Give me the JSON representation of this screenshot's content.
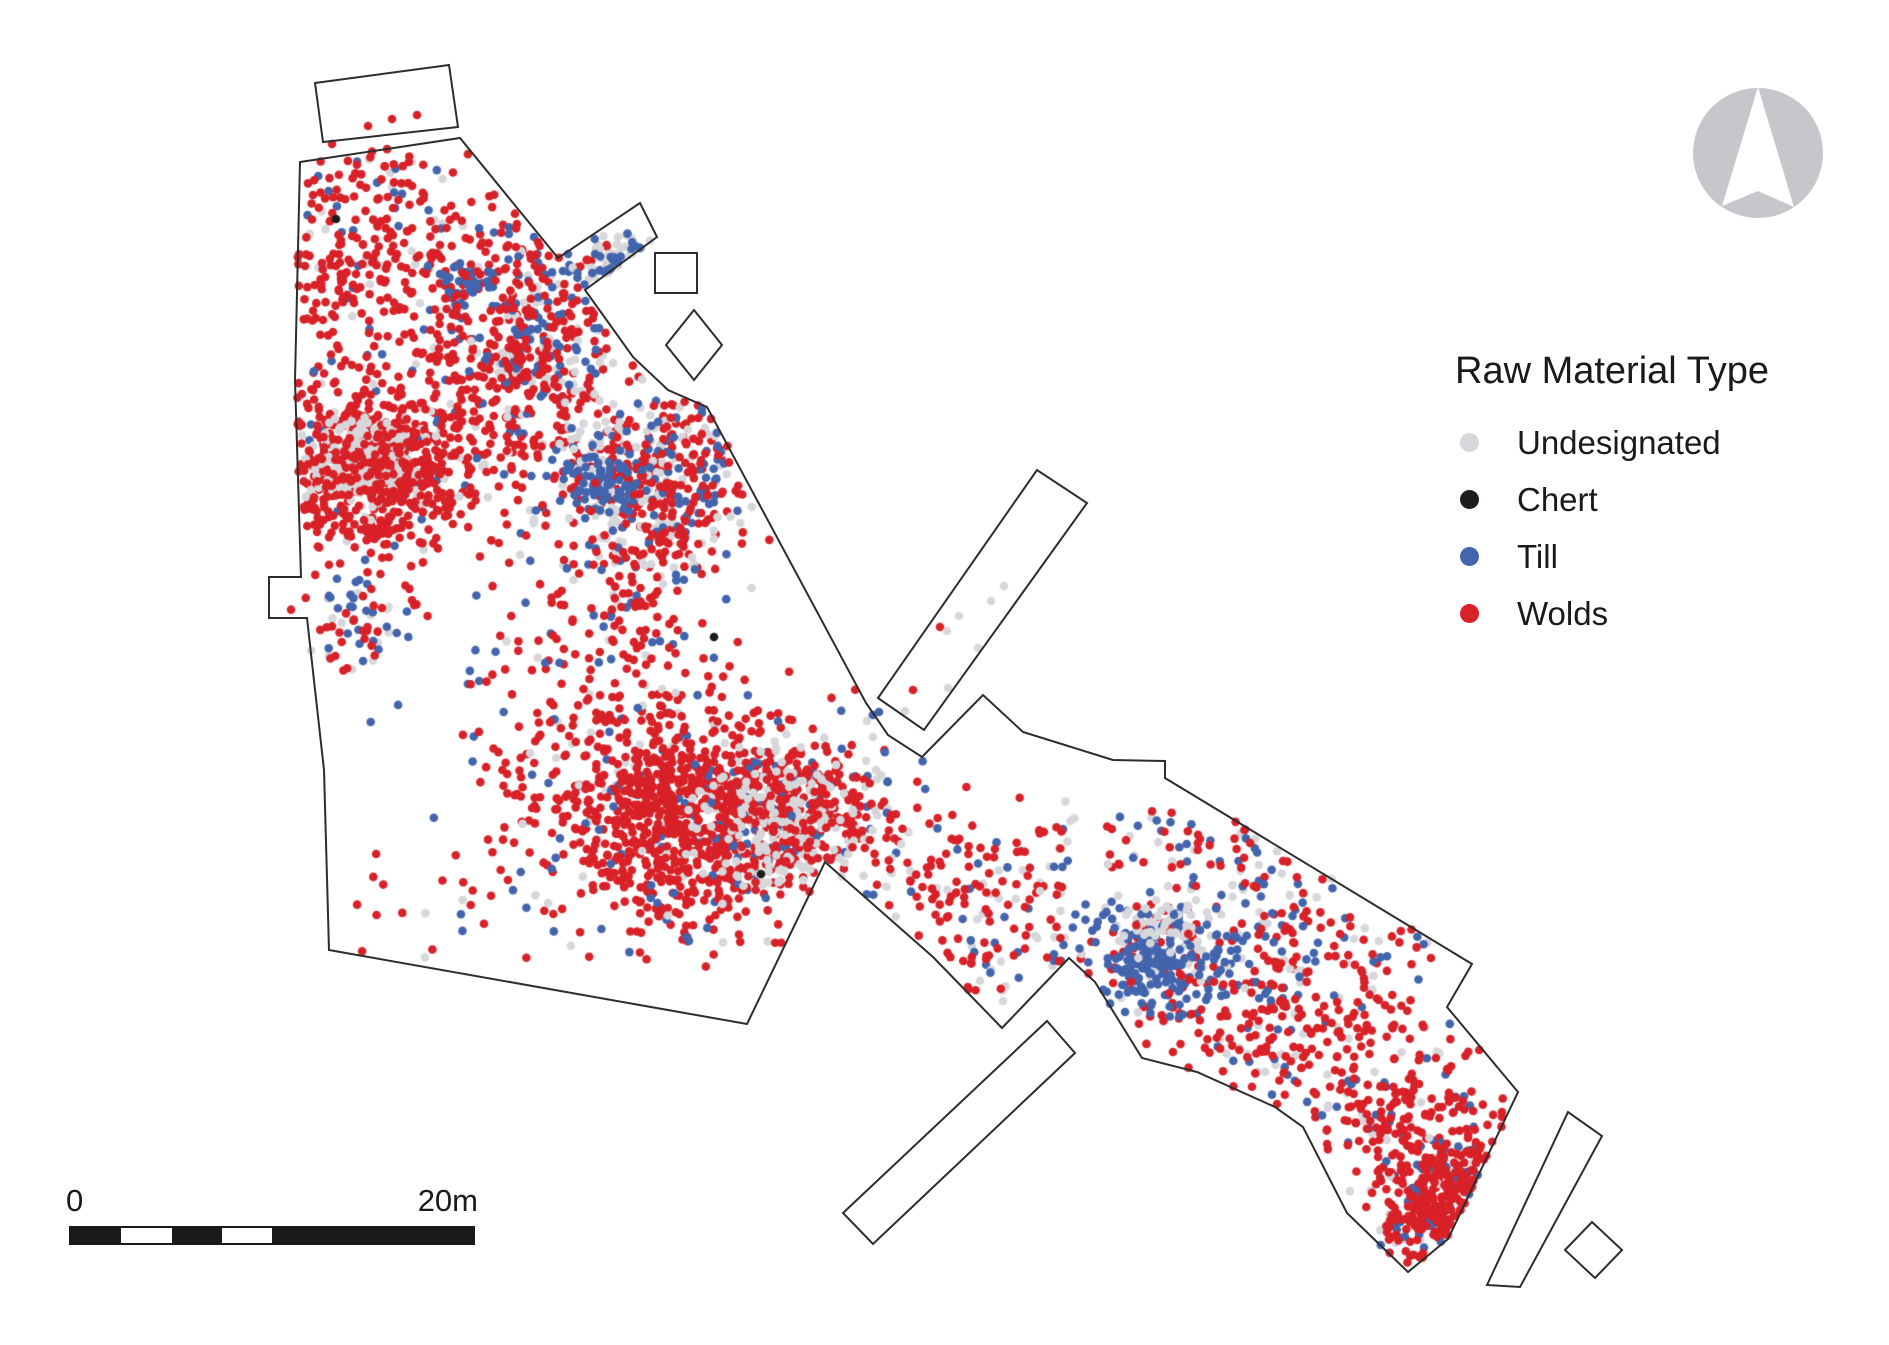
{
  "legend": {
    "title": "Raw Material Type",
    "items": [
      {
        "key": "undesignated",
        "label": "Undesignated",
        "color": "#d7d7db"
      },
      {
        "key": "chert",
        "label": "Chert",
        "color": "#1f1c1d"
      },
      {
        "key": "till",
        "label": "Till",
        "color": "#4365ad"
      },
      {
        "key": "wolds",
        "label": "Wolds",
        "color": "#d92128"
      }
    ]
  },
  "scale_bar": {
    "start_label": "0",
    "end_label": "20m",
    "total_m": 20,
    "width_px": 406,
    "color": "#1a1a1a",
    "segments": [
      {
        "m": 2.5,
        "fill": "dark"
      },
      {
        "m": 2.5,
        "fill": "light"
      },
      {
        "m": 2.5,
        "fill": "dark"
      },
      {
        "m": 2.5,
        "fill": "light"
      },
      {
        "m": 10,
        "fill": "dark"
      }
    ]
  },
  "north_arrow": {
    "cx": 1758,
    "cy": 153,
    "r": 65,
    "circle_color": "#c6c6cb",
    "arrow_color": "#ffffff",
    "arrow_points": [
      [
        1758,
        87
      ],
      [
        1794,
        207
      ],
      [
        1758,
        191
      ],
      [
        1722,
        206
      ]
    ]
  },
  "map": {
    "stroke_color": "#2d2d2d",
    "stroke_width": 2,
    "shapes": [
      {
        "name": "main-excavation-outline",
        "points": [
          [
            300,
            162
          ],
          [
            460,
            138
          ],
          [
            558,
            258
          ],
          [
            640,
            203
          ],
          [
            657,
            237
          ],
          [
            585,
            290
          ],
          [
            633,
            357
          ],
          [
            668,
            390
          ],
          [
            707,
            407
          ],
          [
            866,
            703
          ],
          [
            888,
            735
          ],
          [
            922,
            757
          ],
          [
            983,
            695
          ],
          [
            1023,
            732
          ],
          [
            1113,
            760
          ],
          [
            1165,
            761
          ],
          [
            1165,
            778
          ],
          [
            1472,
            964
          ],
          [
            1447,
            1007
          ],
          [
            1518,
            1092
          ],
          [
            1448,
            1239
          ],
          [
            1408,
            1272
          ],
          [
            1347,
            1213
          ],
          [
            1303,
            1127
          ],
          [
            1275,
            1107
          ],
          [
            1197,
            1072
          ],
          [
            1142,
            1058
          ],
          [
            1095,
            982
          ],
          [
            1069,
            958
          ],
          [
            1002,
            1028
          ],
          [
            933,
            957
          ],
          [
            825,
            862
          ],
          [
            747,
            1024
          ],
          [
            329,
            950
          ],
          [
            324,
            770
          ],
          [
            307,
            618
          ],
          [
            269,
            618
          ],
          [
            269,
            577
          ],
          [
            301,
            577
          ],
          [
            295,
            380
          ]
        ]
      },
      {
        "name": "north-detached-rectangle",
        "points": [
          [
            315,
            83
          ],
          [
            449,
            65
          ],
          [
            458,
            127
          ],
          [
            323,
            142
          ]
        ]
      },
      {
        "name": "small-square-ne",
        "points": [
          [
            655,
            253
          ],
          [
            697,
            253
          ],
          [
            697,
            293
          ],
          [
            655,
            293
          ]
        ]
      },
      {
        "name": "tilted-square-ne",
        "points": [
          [
            694,
            310
          ],
          [
            722,
            345
          ],
          [
            694,
            380
          ],
          [
            666,
            345
          ]
        ]
      },
      {
        "name": "long-rectangle-ne",
        "points": [
          [
            878,
            698
          ],
          [
            1037,
            470
          ],
          [
            1087,
            503
          ],
          [
            924,
            730
          ]
        ]
      },
      {
        "name": "long-rectangle-sw",
        "points": [
          [
            843,
            1213
          ],
          [
            1047,
            1021
          ],
          [
            1075,
            1053
          ],
          [
            873,
            1244
          ]
        ]
      },
      {
        "name": "long-rectangle-se",
        "points": [
          [
            1487,
            1285
          ],
          [
            1568,
            1112
          ],
          [
            1602,
            1136
          ],
          [
            1520,
            1287
          ]
        ]
      },
      {
        "name": "small-diamond-se",
        "points": [
          [
            1592,
            1222
          ],
          [
            1622,
            1250
          ],
          [
            1595,
            1278
          ],
          [
            1565,
            1250
          ]
        ]
      }
    ]
  },
  "chart_data": {
    "type": "scatter",
    "title": "Raw Material Type",
    "coordinate_space": "image pixels, 1889x1345, origin top-left",
    "point_radius": 4.3,
    "seed": 42,
    "categories": {
      "undesignated": {
        "label": "Undesignated",
        "color": "#d7d7db"
      },
      "chert": {
        "label": "Chert",
        "color": "#1f1c1d"
      },
      "till": {
        "label": "Till",
        "color": "#4365ad"
      },
      "wolds": {
        "label": "Wolds",
        "color": "#d92128"
      }
    },
    "clusters": [
      {
        "id": "nw-scatter",
        "cx": 385,
        "cy": 245,
        "sx": 62,
        "sy": 58,
        "parts": [
          [
            "undesignated",
            25
          ],
          [
            "till",
            30
          ],
          [
            "wolds",
            200
          ]
        ]
      },
      {
        "id": "nw-left-edge",
        "cx": 318,
        "cy": 300,
        "sx": 22,
        "sy": 55,
        "parts": [
          [
            "wolds",
            40
          ]
        ]
      },
      {
        "id": "nw-blue-patch",
        "cx": 462,
        "cy": 280,
        "sx": 16,
        "sy": 12,
        "parts": [
          [
            "wolds",
            15
          ],
          [
            "till",
            35
          ]
        ]
      },
      {
        "id": "nw-mid-trail",
        "cx": 480,
        "cy": 385,
        "sx": 55,
        "sy": 70,
        "parts": [
          [
            "undesignated",
            20
          ],
          [
            "till",
            15
          ],
          [
            "wolds",
            190
          ]
        ]
      },
      {
        "id": "vertical-streak",
        "cx": 542,
        "cy": 330,
        "sx": 32,
        "sy": 62,
        "parts": [
          [
            "undesignated",
            50
          ],
          [
            "till",
            70
          ],
          [
            "wolds",
            150
          ]
        ]
      },
      {
        "id": "corridor-mouth-gray",
        "cx": 638,
        "cy": 272,
        "sx": 22,
        "sy": 15,
        "parts": [
          [
            "wolds",
            12
          ],
          [
            "undesignated",
            48
          ],
          [
            "till",
            22
          ]
        ]
      },
      {
        "id": "west-blob",
        "cx": 370,
        "cy": 467,
        "sx": 58,
        "sy": 48,
        "parts": [
          [
            "till",
            25
          ],
          [
            "undesignated",
            30
          ],
          [
            "wolds",
            430
          ]
        ]
      },
      {
        "id": "west-blob-gray-core",
        "cx": 362,
        "cy": 463,
        "sx": 26,
        "sy": 20,
        "parts": [
          [
            "undesignated",
            170
          ]
        ]
      },
      {
        "id": "west-blob-red-top",
        "cx": 372,
        "cy": 470,
        "sx": 36,
        "sy": 30,
        "parts": [
          [
            "wolds",
            170
          ]
        ]
      },
      {
        "id": "mixed-blob",
        "cx": 640,
        "cy": 478,
        "sx": 52,
        "sy": 48,
        "parts": [
          [
            "wolds",
            170
          ],
          [
            "undesignated",
            140
          ],
          [
            "till",
            120
          ]
        ]
      },
      {
        "id": "mixed-blob-red",
        "cx": 685,
        "cy": 492,
        "sx": 38,
        "sy": 42,
        "parts": [
          [
            "wolds",
            90
          ]
        ]
      },
      {
        "id": "mixed-blob-blue-core",
        "cx": 600,
        "cy": 487,
        "sx": 19,
        "sy": 15,
        "parts": [
          [
            "till",
            55
          ]
        ]
      },
      {
        "id": "mid-trail",
        "cx": 610,
        "cy": 625,
        "sx": 55,
        "sy": 65,
        "parts": [
          [
            "undesignated",
            15
          ],
          [
            "till",
            20
          ],
          [
            "wolds",
            150
          ]
        ]
      },
      {
        "id": "mid-sparse",
        "cx": 480,
        "cy": 690,
        "sx": 60,
        "sy": 60,
        "parts": [
          [
            "till",
            12
          ],
          [
            "wolds",
            10
          ]
        ]
      },
      {
        "id": "west-notch-cluster",
        "cx": 358,
        "cy": 625,
        "sx": 25,
        "sy": 30,
        "parts": [
          [
            "undesignated",
            14
          ],
          [
            "till",
            25
          ],
          [
            "wolds",
            28
          ]
        ]
      },
      {
        "id": "south-north-ext",
        "cx": 700,
        "cy": 755,
        "sx": 68,
        "sy": 32,
        "parts": [
          [
            "undesignated",
            25
          ],
          [
            "till",
            25
          ],
          [
            "wolds",
            160
          ]
        ]
      },
      {
        "id": "south-left",
        "cx": 578,
        "cy": 790,
        "sx": 50,
        "sy": 42,
        "parts": [
          [
            "wolds",
            90
          ]
        ]
      },
      {
        "id": "south-main",
        "cx": 678,
        "cy": 832,
        "sx": 64,
        "sy": 46,
        "parts": [
          [
            "undesignated",
            40
          ],
          [
            "till",
            30
          ],
          [
            "wolds",
            500
          ]
        ]
      },
      {
        "id": "south-gray-east",
        "cx": 788,
        "cy": 816,
        "sx": 46,
        "sy": 38,
        "parts": [
          [
            "till",
            60
          ],
          [
            "wolds",
            200
          ],
          [
            "undesignated",
            170
          ]
        ]
      },
      {
        "id": "south-red-top",
        "cx": 802,
        "cy": 822,
        "sx": 36,
        "sy": 26,
        "parts": [
          [
            "wolds",
            60
          ]
        ]
      },
      {
        "id": "bottom-sparse",
        "cx": 480,
        "cy": 900,
        "sx": 75,
        "sy": 30,
        "parts": [
          [
            "wolds",
            20
          ],
          [
            "till",
            8
          ],
          [
            "undesignated",
            6
          ]
        ]
      },
      {
        "id": "south-below",
        "cx": 662,
        "cy": 915,
        "sx": 50,
        "sy": 25,
        "parts": [
          [
            "wolds",
            20
          ],
          [
            "till",
            12
          ],
          [
            "undesignated",
            6
          ]
        ]
      },
      {
        "id": "neck-trail",
        "cx": 958,
        "cy": 868,
        "sx": 78,
        "sy": 48,
        "parts": [
          [
            "undesignated",
            30
          ],
          [
            "till",
            25
          ],
          [
            "wolds",
            105
          ]
        ]
      },
      {
        "id": "neck-low",
        "cx": 1005,
        "cy": 962,
        "sx": 60,
        "sy": 40,
        "parts": [
          [
            "undesignated",
            15
          ],
          [
            "till",
            10
          ],
          [
            "wolds",
            30
          ]
        ]
      },
      {
        "id": "east-strip-nw",
        "cx": 1225,
        "cy": 855,
        "sx": 75,
        "sy": 45,
        "parts": [
          [
            "undesignated",
            25
          ],
          [
            "till",
            32
          ],
          [
            "wolds",
            40
          ]
        ]
      },
      {
        "id": "east-mid-sparse",
        "cx": 1338,
        "cy": 948,
        "sx": 60,
        "sy": 40,
        "parts": [
          [
            "undesignated",
            15
          ],
          [
            "till",
            18
          ],
          [
            "wolds",
            48
          ]
        ]
      },
      {
        "id": "east-blue-cluster",
        "cx": 1168,
        "cy": 955,
        "sx": 44,
        "sy": 33,
        "parts": [
          [
            "wolds",
            65
          ],
          [
            "undesignated",
            55
          ],
          [
            "till",
            150
          ]
        ]
      },
      {
        "id": "east-blue-core",
        "cx": 1152,
        "cy": 962,
        "sx": 20,
        "sy": 14,
        "parts": [
          [
            "till",
            55
          ]
        ]
      },
      {
        "id": "east-gray-patch",
        "cx": 1172,
        "cy": 925,
        "sx": 20,
        "sy": 12,
        "parts": [
          [
            "undesignated",
            35
          ]
        ]
      },
      {
        "id": "east-trail",
        "cx": 1290,
        "cy": 1030,
        "sx": 70,
        "sy": 45,
        "parts": [
          [
            "undesignated",
            25
          ],
          [
            "till",
            30
          ],
          [
            "wolds",
            165
          ]
        ]
      },
      {
        "id": "pre-tip-cluster",
        "cx": 1402,
        "cy": 1118,
        "sx": 45,
        "sy": 35,
        "parts": [
          [
            "undesignated",
            15
          ],
          [
            "till",
            25
          ],
          [
            "wolds",
            135
          ]
        ]
      },
      {
        "id": "tip-cluster",
        "cx": 1458,
        "cy": 1206,
        "sx": 38,
        "sy": 32,
        "parts": [
          [
            "undesignated",
            25
          ],
          [
            "till",
            45
          ],
          [
            "wolds",
            225
          ]
        ]
      }
    ],
    "extra_points": [
      {
        "cat": "wolds",
        "pts": [
          [
            332,
            144
          ],
          [
            368,
            126
          ],
          [
            392,
            119
          ],
          [
            417,
            115
          ],
          [
            940,
            627
          ],
          [
            913,
            690
          ]
        ]
      },
      {
        "cat": "undesignated",
        "pts": [
          [
            947,
            631
          ],
          [
            959,
            616
          ],
          [
            978,
            648
          ],
          [
            991,
            601
          ],
          [
            1004,
            586
          ],
          [
            948,
            688
          ],
          [
            905,
            711
          ],
          [
            867,
            721
          ],
          [
            873,
            737
          ]
        ]
      },
      {
        "cat": "till",
        "pts": [
          [
            879,
            712
          ]
        ]
      },
      {
        "cat": "chert",
        "pts": [
          [
            336,
            219
          ],
          [
            714,
            637
          ],
          [
            761,
            874
          ]
        ]
      }
    ]
  }
}
